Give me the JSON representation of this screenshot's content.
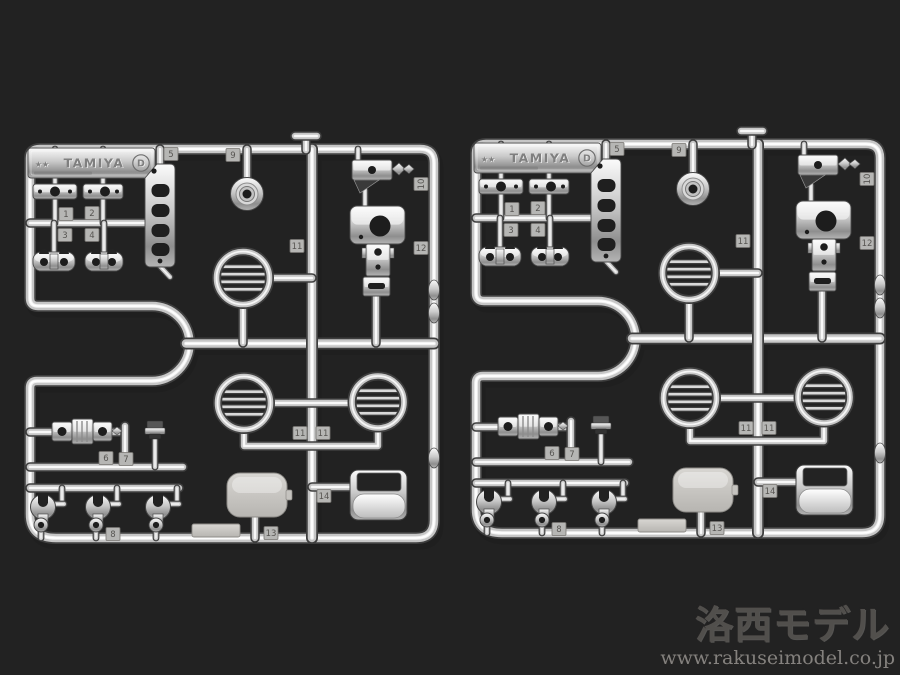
{
  "photo": {
    "subject": "two identical chrome-plated model kit part sprues on a gray studio background"
  },
  "sprue": {
    "brand": "TAMIYA",
    "brand_stars": "★★",
    "runner_letter": "D",
    "part_tags": {
      "t1": "1",
      "t2": "2",
      "t3": "3",
      "t4": "4",
      "t5": "5",
      "t6": "6",
      "t7": "7",
      "t8": "8",
      "t9": "9",
      "t10": "10",
      "t11a": "11",
      "t11b": "11",
      "t11c": "11",
      "t12": "12",
      "t13": "13",
      "t14": "14"
    }
  },
  "sprues": [
    {
      "id": "sprue-left"
    },
    {
      "id": "sprue-right"
    }
  ],
  "watermark": {
    "title": "洛西モデル",
    "url": "www.rakuseimodel.co.jp"
  },
  "colors": {
    "background": "#6b6763",
    "background_edge": "#4f4c49",
    "chrome_dark": "#3e3e3e",
    "chrome_mid": "#c6c6c6",
    "chrome_light": "#f1f1f1",
    "matte_plate": "#cbc9c5"
  }
}
